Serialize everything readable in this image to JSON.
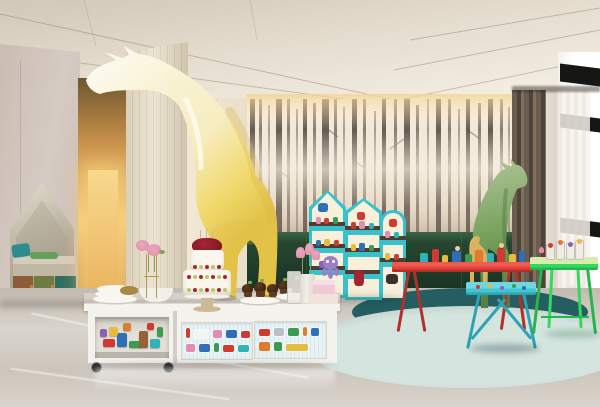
{
  "scene": {
    "title": "Children playroom interior with giant giraffe sculpture",
    "setting": "hotel kids club room, 3D architectural render, no on-screen text",
    "objects": [
      {
        "name": "giraffe-sculpture-yellow",
        "description": "giant glossy giraffe, white head fading to yellow body, neck arching across ceiling, standing behind white counter"
      },
      {
        "name": "giraffe-sculpture-green",
        "description": "smaller green giraffe sculpture in front of forest wallpaper"
      },
      {
        "name": "toy-giraffe-small",
        "description": "small tan wooden giraffe toy beside green giraffe"
      },
      {
        "name": "forest-wallpaper",
        "description": "sepia misty forest mural with tree trunks"
      },
      {
        "name": "wainscot",
        "description": "dark green lower wall panel under mural"
      },
      {
        "name": "house-shelves",
        "description": "three house-shaped cream shelving units with turquoise frames, toys and pirate stickers"
      },
      {
        "name": "red-activity-table",
        "description": "long red metal table topped with colorful toy figures"
      },
      {
        "name": "kids-table-teal",
        "description": "small turquoise kids table with doodled top"
      },
      {
        "name": "side-table-green",
        "description": "bright green side table with candy glasses"
      },
      {
        "name": "white-counter",
        "description": "white storage counter; left open trolley full of building blocks, right doors decorated with vehicle stickers"
      },
      {
        "name": "birthday-cake",
        "description": "tiered white cake with cherries and kiwi on pedestal stand"
      },
      {
        "name": "cupcakes",
        "description": "two plates of chocolate cupcakes"
      },
      {
        "name": "plate-stack",
        "description": "stacked white plates and bowls"
      },
      {
        "name": "flowers",
        "description": "pink roses in wire stand and pink tulips in white vase"
      },
      {
        "name": "gift-boxes",
        "description": "stacked pink gift boxes with purple octopus plush"
      },
      {
        "name": "wall-niche",
        "description": "house-shaped alcove with bench, teal cushions and tricolor toy cabinets"
      },
      {
        "name": "hallway",
        "description": "warm golden backlit corridor"
      },
      {
        "name": "wood-column",
        "description": "light wood full-height column"
      },
      {
        "name": "curtains",
        "description": "dark taupe drapes with white sheer at floor-to-ceiling window"
      },
      {
        "name": "window",
        "description": "bright window with black frame bars and greenery outside"
      },
      {
        "name": "rugs",
        "description": "overlapping dark teal and pale mint round rugs"
      },
      {
        "name": "floor",
        "description": "polished grey marble floor with reflections"
      }
    ]
  },
  "colors": {
    "ceil-a": "#d2c7b8",
    "ceil-b": "#e6ded0",
    "ceil-c": "#f3eee2",
    "ceil-seam": "rgba(130,115,95,0.38)",
    "cove-glow": "rgba(244,212,150,0.85)",
    "wall-left-a": "#d6cbc4",
    "wall-left-b": "#c9bcb2",
    "niche-a": "#d8d2c2",
    "niche-b": "#b7af9e",
    "niche-c": "#a29885",
    "bench-top": "#d5cdbc",
    "bench-front": "#c0b7a5",
    "door-brown": "#8c5c38",
    "door-olive": "#6e7b42",
    "door-teal": "#2f6d5e",
    "knob": "#d98230",
    "plinth": "#57504a",
    "hall-top": "#6e5530",
    "hall-mid": "#c9914a",
    "hall-glow": "#f4cf7e",
    "hall-floor": "#bf8f45",
    "col-a": "#e8dfca",
    "col-b": "#d9cdb2",
    "cream": "#f1e8d5",
    "cream-line": "#ded2ba",
    "wp-a": "#f5ede0",
    "wp-b": "#ebdfcd",
    "wp-c": "#decfbb",
    "trunk-a": "#665950",
    "trunk-b": "#8a7b6c",
    "trunk-c": "#a89a8b",
    "wains-a": "#264530",
    "wains-b": "#193322",
    "wains-hi": "#3a6345",
    "curt-a": "#6a5d4f",
    "curt-b": "#4e453a",
    "curt-c": "#80715f",
    "sheer": "rgba(243,238,230,0.78)",
    "win-bar": "#161614",
    "green-a": "#94aa6a",
    "green-b": "#70904e",
    "sill": "#23221f",
    "floor-a": "#c3bbb1",
    "floor-b": "#d9d4cc",
    "floor-c": "#ccc5bc",
    "rug-dk": "#245e61",
    "rug-lt": "#d4e4df",
    "gir-w": "#fcfaf1",
    "gir-c": "#f7edc2",
    "gir-y": "#f1da70",
    "gir-d": "#e2c247",
    "ggir-a": "#a8c08f",
    "ggir-b": "#719d57",
    "ggir-c": "#547e45",
    "toygir": "#d9b35e",
    "shelf-t": "#38c1cb",
    "shelf-td": "#279fac",
    "shelf-c": "#f7f0da",
    "shelf-s": "#4c3e30",
    "red-t": "#e4433c",
    "red-d": "#b23028",
    "teal-t": "#41c5d0",
    "teal-d": "#2da4b0",
    "grn-t": "#30da5c",
    "grn-d": "#28b54d",
    "grn-top": "#d8ecae",
    "cw": "#f3f2ed",
    "ctop-a": "#d5d0c8",
    "ctop-b": "#c4beb4",
    "panel-bg": "#e9f3f5",
    "panel-st": "#d5e8ec",
    "cart-in": "#e3e0d7",
    "cake-w": "#fbf7ee",
    "cherry": "#7c1622",
    "cherry2": "#a42432",
    "kiwi": "#b9c85c",
    "stand": "#ccb998",
    "plate-w": "#f3f1ea",
    "cup-a": "#402515",
    "cup-b": "#5e3c20",
    "sprig": "#6fae4e",
    "glass": "rgba(238,236,229,0.85)",
    "vase": "#f1efe8",
    "tulip": "#eaa8bc",
    "tulip2": "#e18ca8",
    "stem": "#83a05e",
    "box-a": "#f0c9d5",
    "box-b": "#f2e2dc",
    "octo": "#9d7ec4",
    "t-red": "#cf3b30",
    "t-blue": "#2f6fb8",
    "t-green": "#3d9a52",
    "t-yellow": "#e7bc3f",
    "t-orange": "#e07b2e",
    "t-teal": "#2fb3b8",
    "t-pink": "#e58bb0",
    "t-purple": "#8a62b5",
    "t-brown": "#96603a",
    "t-grey": "#b9c1c7",
    "t-skin": "#ead0a0",
    "gold": "#a98b3f",
    "wire": "#b59a56",
    "shadow": "rgba(30,25,20,0.18)"
  }
}
